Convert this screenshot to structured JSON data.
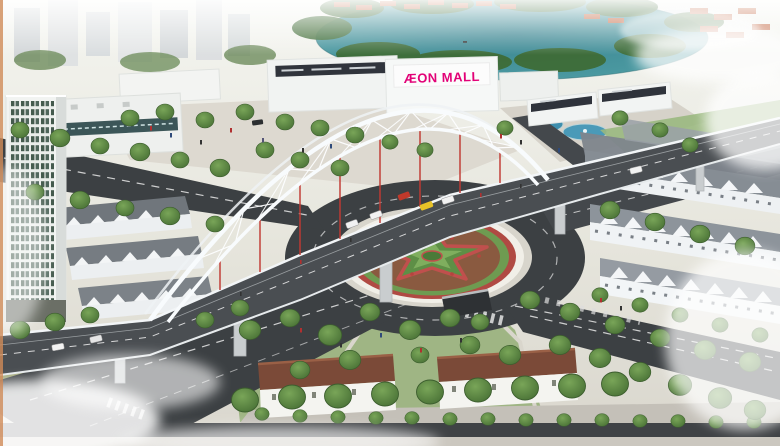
{
  "scene": {
    "signs": {
      "mall": "ÆON MALL"
    },
    "colors": {
      "mall_sign": "#e20177",
      "lake": "#45939c",
      "road": "#3c4043",
      "arch_white": "#f8fbfd",
      "hanger_red": "#c13a33",
      "tree_green": "#4e7d3c",
      "roof_brown": "#7b4a38",
      "roof_gray": "#8d949b",
      "star_green": "#5e8f46",
      "flower_red": "#b5453e",
      "soil_brown": "#8a5a40",
      "border_orange": "#cf8b57"
    }
  }
}
